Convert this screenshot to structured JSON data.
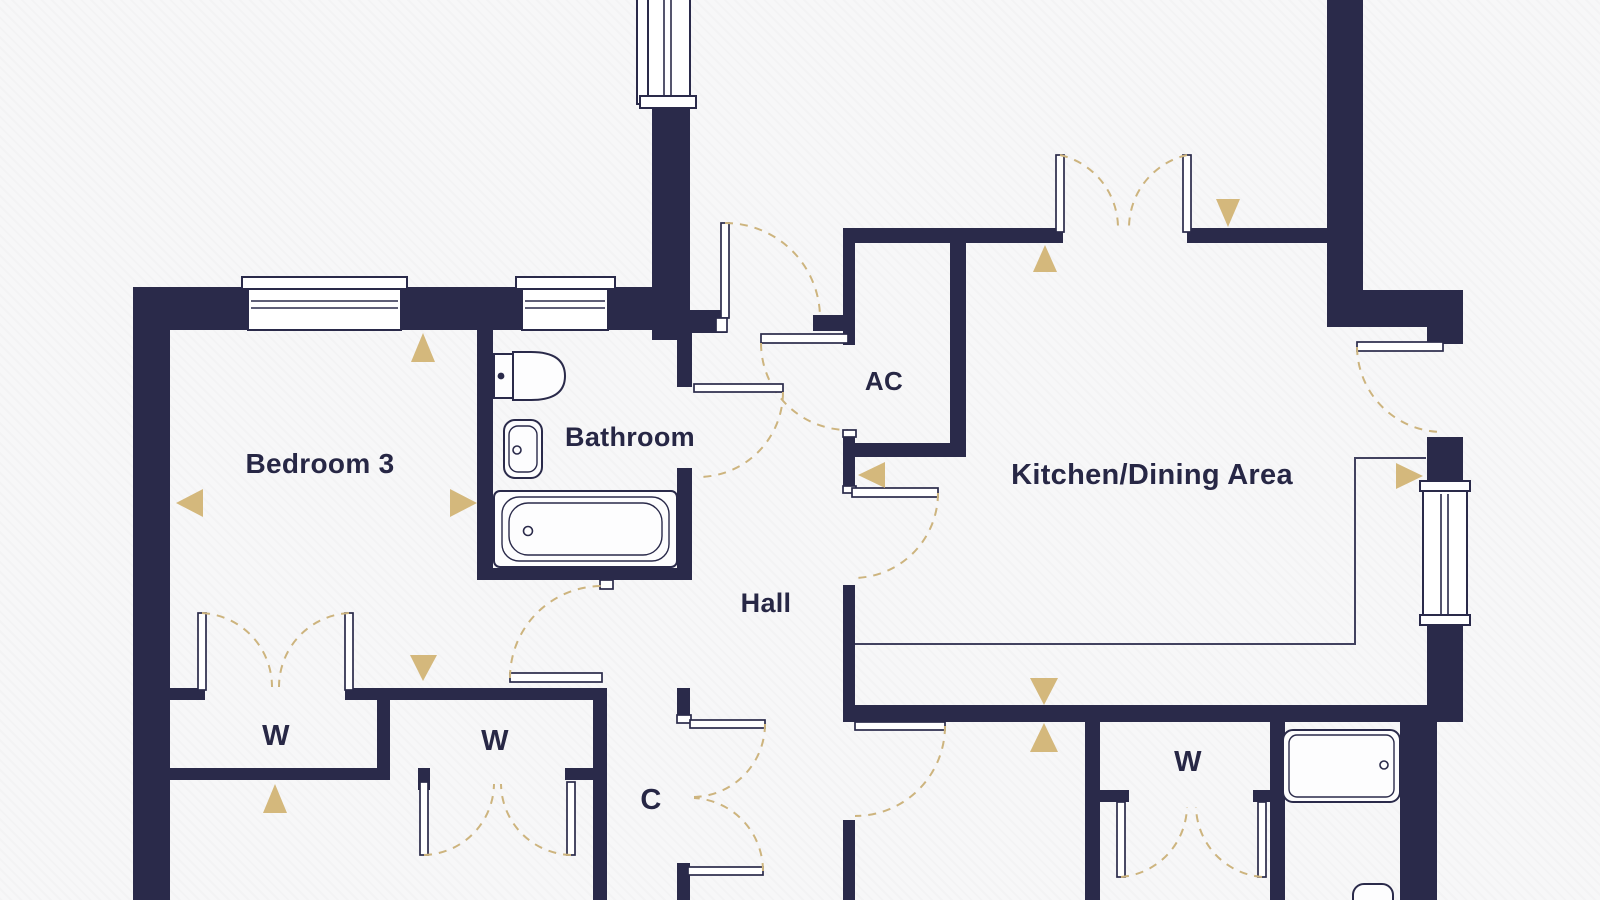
{
  "plan": {
    "type": "apartment-floor-plan",
    "colors": {
      "wall": "#2a2a4a",
      "gold_marker": "#d4b87c",
      "door_swing": "#cdb47e",
      "background": "#f7f7f8",
      "label_text": "#272745"
    },
    "rooms": [
      {
        "id": "bedroom-3",
        "label": "Bedroom 3"
      },
      {
        "id": "bathroom",
        "label": "Bathroom"
      },
      {
        "id": "airing-cupboard",
        "label": "AC"
      },
      {
        "id": "kitchen-dining-area",
        "label": "Kitchen/Dining Area"
      },
      {
        "id": "hall",
        "label": "Hall"
      },
      {
        "id": "wardrobe-bedroom3",
        "label": "W"
      },
      {
        "id": "wardrobe-middle",
        "label": "W"
      },
      {
        "id": "wardrobe-ensuite",
        "label": "W"
      },
      {
        "id": "cupboard",
        "label": "C"
      }
    ],
    "fixtures": [
      "toilet",
      "basin",
      "bathtub",
      "kitchen-counter",
      "shower-tray",
      "toilet-ensuite"
    ],
    "markers": {
      "shape": "triangle",
      "count": 11
    },
    "features": [
      "double-doors",
      "bifold-wardrobe-doors",
      "windows",
      "door-swing-arcs"
    ]
  }
}
